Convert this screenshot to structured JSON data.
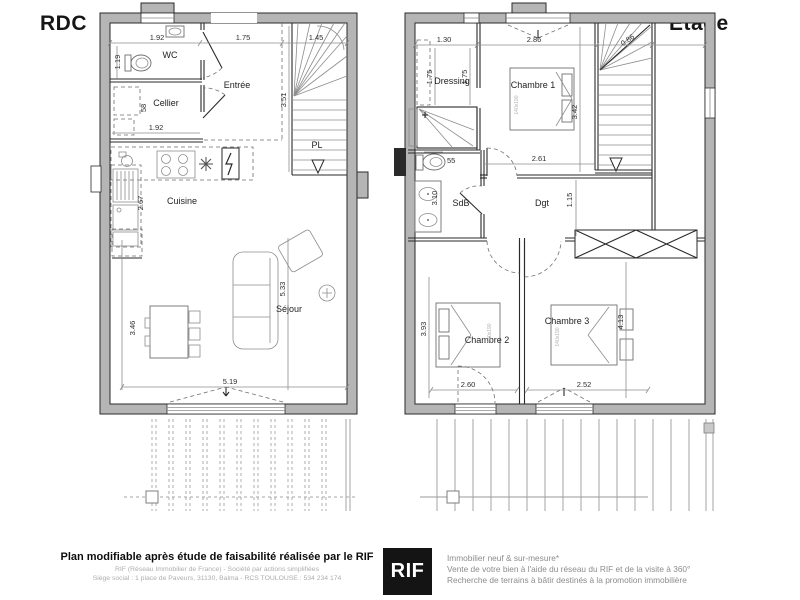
{
  "titles": {
    "left": "RDC",
    "right": "Etage"
  },
  "rdc": {
    "rooms": {
      "wc": "WC",
      "entree": "Entrée",
      "cellier": "Cellier",
      "pl": "PL",
      "cuisine": "Cuisine",
      "sejour": "Séjour"
    },
    "dims": {
      "top1": "1.92",
      "top2": "1.75",
      "top3": "1.45",
      "wc_side": "1.19",
      "cellier_w": "1.92",
      "cellier_side": "58",
      "stair_side": "3.51",
      "kitchen_side": "2.67",
      "sejour_left": "3.46",
      "sejour_right": "5.33",
      "sejour_bottom": "5.19"
    }
  },
  "etage": {
    "rooms": {
      "dressing": "Dressing",
      "ch1": "Chambre 1",
      "sdb": "SdB",
      "dgt": "Dgt",
      "ch2": "Chambre 2",
      "ch3": "Chambre 3"
    },
    "dims": {
      "top1": "1.30",
      "top2": "2.86",
      "top3": "0.86",
      "dressing1": "1.75",
      "dressing2": "1.75",
      "ch1_side": "3.42",
      "wc_w": "55",
      "sdb_side": "3.10",
      "dgt_w": "2.61",
      "dgt_side": "1.15",
      "ch2_side": "3.93",
      "ch3_side": "4.13",
      "ch2_bottom": "2.60",
      "ch3_bottom": "2.52"
    },
    "beds": {
      "b1": "140x190",
      "b2": "140x190",
      "b3": "140x190"
    }
  },
  "footer": {
    "disclaimer_title": "Plan modifiable après étude de faisabilité réalisée par le RIF",
    "company_line1": "RIF (Réseau Immobilier de France) - Société par actions simplifiées",
    "company_line2": "Siège social : 1 place de Paveurs, 31130, Balma - RCS TOULOUSE : 534 234 174",
    "logo_text": "RIF",
    "services": [
      "Immobilier neuf & sur-mesure*",
      "Vente de votre bien à l'aide du réseau du RIF et de la visite à 360°",
      "Recherche de terrains à bâtir destinés à la promotion immobilière"
    ]
  },
  "colors": {
    "wall": "#b5b5b5",
    "line": "#2a2a2a",
    "logo_bg": "#141414"
  }
}
